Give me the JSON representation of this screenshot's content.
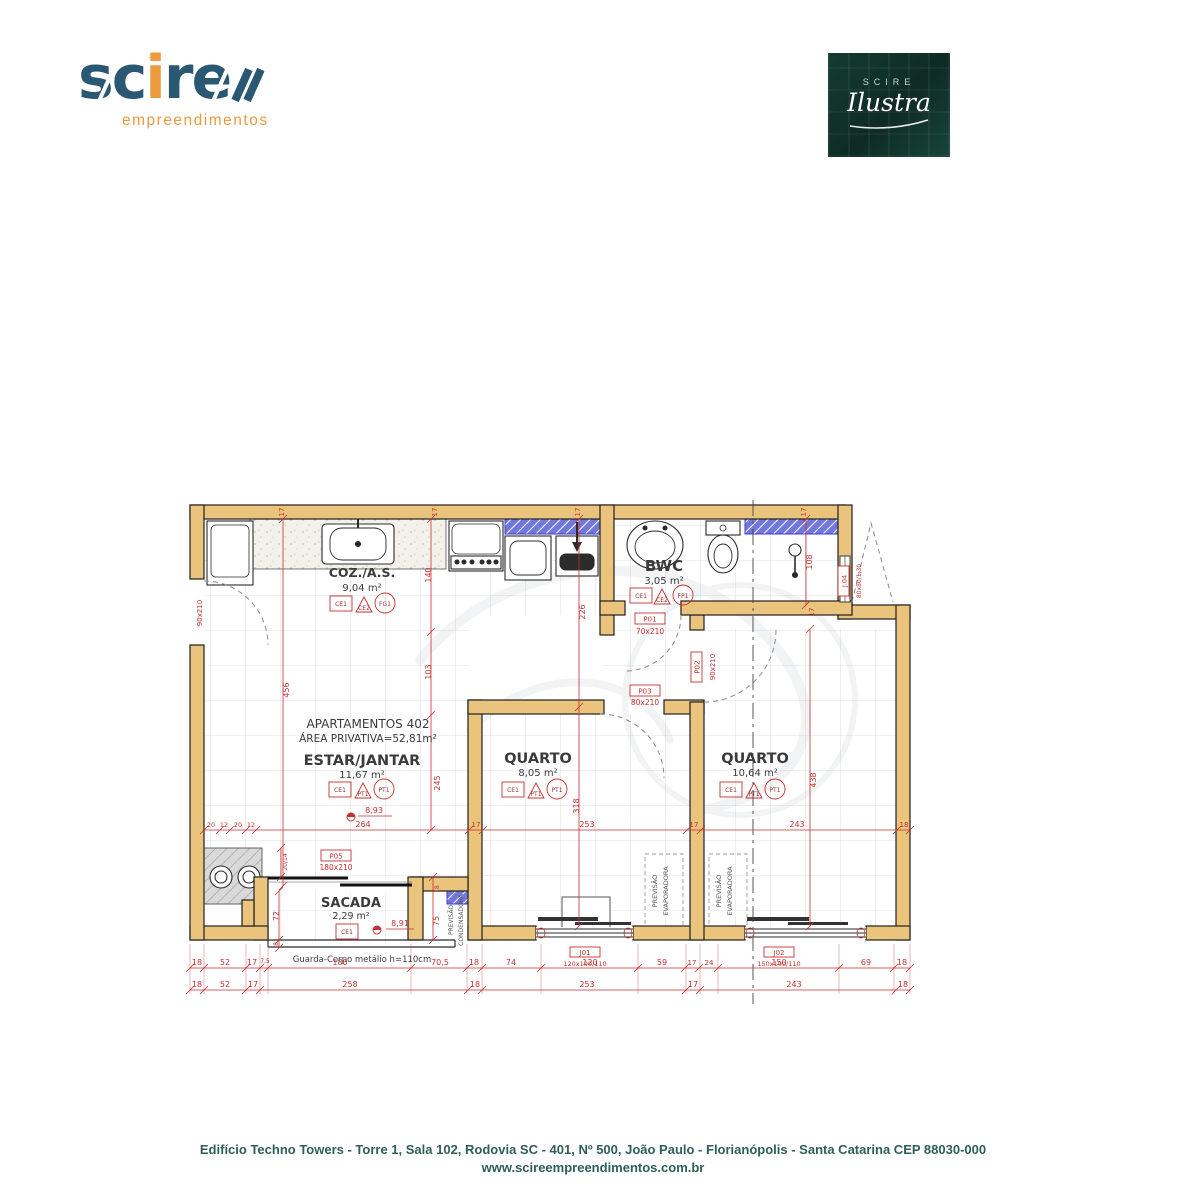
{
  "header": {
    "logo": {
      "brand": "scire",
      "subtitle": "empreendimentos"
    },
    "badge": {
      "small": "SCIRE",
      "script": "Ilustra"
    }
  },
  "plan": {
    "apartment": {
      "title": "APARTAMENTOS 402",
      "area_line": "ÁREA PRIVATIVA=52,81m²"
    },
    "rooms": {
      "coz": {
        "name": "COZ./A.S.",
        "area": "9,04 m²"
      },
      "bwc": {
        "name": "BWC",
        "area": "3,05 m²"
      },
      "estar": {
        "name": "ESTAR/JANTAR",
        "area": "11,67 m²"
      },
      "quarto1": {
        "name": "QUARTO",
        "area": "8,05 m²"
      },
      "quarto2": {
        "name": "QUARTO",
        "area": "10,64 m²"
      },
      "sacada": {
        "name": "SACADA",
        "area": "2,29 m²"
      }
    },
    "tags": {
      "ce1": "CE1",
      "ce2": "CE2",
      "fg1": "FG1",
      "fp1": "FP1",
      "pt1": "PT1"
    },
    "doors": {
      "p01": {
        "id": "P01",
        "size": "70x210"
      },
      "p02": {
        "id": "P02",
        "size": "90x210"
      },
      "p03": {
        "id": "P03",
        "size": "80x210"
      },
      "p05": {
        "id": "P05",
        "size": "180x210"
      },
      "entry": {
        "size": "90x210"
      }
    },
    "windows": {
      "j01": {
        "id": "J01",
        "size": "120x100/110"
      },
      "j02": {
        "id": "J02",
        "size": "150x100/110"
      },
      "j04": {
        "id": "J.04",
        "size": "80x80/1,30"
      }
    },
    "levels": {
      "estar": "8,93",
      "sacada": "8,91"
    },
    "notes": {
      "guard": "Guarda-Corpo metálio h=110cm",
      "previsao": "PREVISÃO",
      "evaporadora": "EVAPORADORA",
      "condensadora": "CONDENSADORA"
    },
    "dims": {
      "v7_5": "7,5",
      "v8": "8",
      "v12": "12",
      "v17": "17",
      "v18": "18",
      "v20": "20",
      "v20_14": "20/14",
      "v24": "24",
      "v52": "52",
      "v59": "59",
      "v69": "69",
      "v70_5": "70,5",
      "v72": "72",
      "v74": "74",
      "v75": "75",
      "v103": "103",
      "v108": "108",
      "v120": "120",
      "v140": "140",
      "v150": "150",
      "v180": "180",
      "v226": "226",
      "v243": "243",
      "v245": "245",
      "v253": "253",
      "v258": "258",
      "v264": "264",
      "v318": "318",
      "v438": "438",
      "v456": "456"
    }
  },
  "footer": {
    "line1": "Edifício Techno Towers - Torre 1, Sala 102, Rodovia SC - 401, Nº 500,  João Paulo - Florianópolis - Santa Catarina CEP 88030-000",
    "line2": "www.scireempreendimentos.com.br"
  },
  "colors": {
    "wall": "#EAC47D",
    "dimension": "#C53030",
    "granite": "#7277DE",
    "footer_text": "#2E5F58",
    "logo_navy": "#2A5873",
    "logo_orange": "#EE9A3F",
    "badge_bg": "#11302A"
  }
}
